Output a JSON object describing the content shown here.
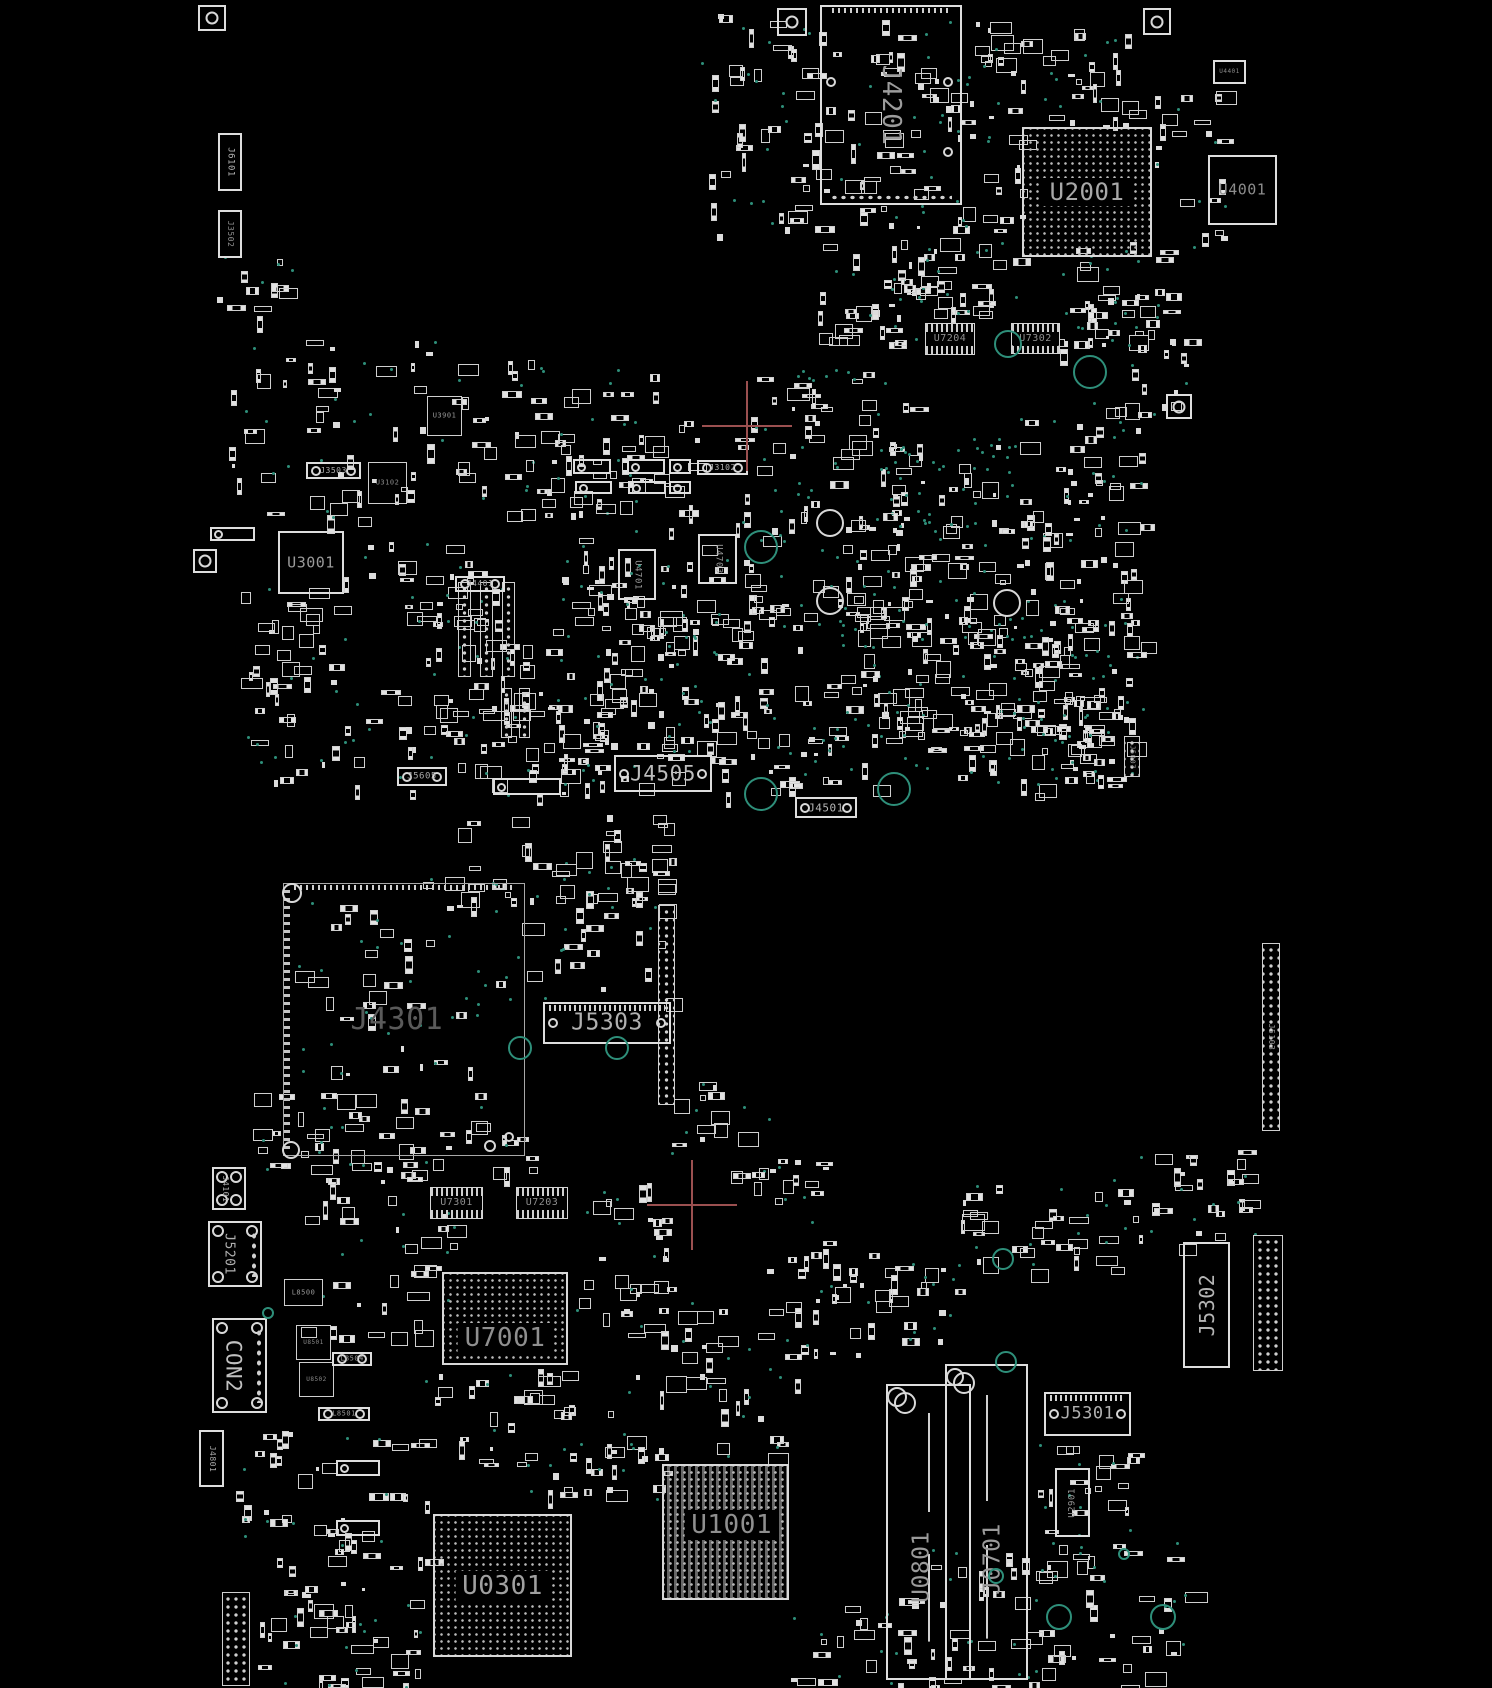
{
  "meta": {
    "width": 1492,
    "height": 1688,
    "background": "#000000"
  },
  "colors": {
    "silk": "#dedede",
    "label": "#9a9a9a",
    "label_dim": "#5a5a5a",
    "via": "#2e8f7a",
    "crosshair": "#9b5050"
  },
  "components": [
    {
      "id": "J6101",
      "label": "J6101",
      "x": 218,
      "y": 133,
      "w": 24,
      "h": 58,
      "type": "connector-v",
      "ls": 9,
      "lr": "cw",
      "lc": "#b5b5b5"
    },
    {
      "id": "J3502",
      "label": "J3502",
      "x": 218,
      "y": 210,
      "w": 24,
      "h": 48,
      "type": "connector-v",
      "ls": 8,
      "lr": "cw",
      "lc": "#8f8f8f"
    },
    {
      "id": "J4201",
      "label": "J4201",
      "x": 820,
      "y": 5,
      "w": 142,
      "h": 200,
      "type": "module",
      "ls": 26,
      "lr": "cw",
      "lc": "#9c9c9c"
    },
    {
      "id": "U2001",
      "label": "U2001",
      "x": 1022,
      "y": 127,
      "w": 130,
      "h": 130,
      "type": "bga",
      "ls": 24,
      "lc": "#a8a8a8"
    },
    {
      "id": "U4001",
      "label": "U4001",
      "x": 1208,
      "y": 155,
      "w": 69,
      "h": 70,
      "type": "chip",
      "ls": 15,
      "lc": "#8c8c8c"
    },
    {
      "id": "U4401",
      "label": "U4401",
      "x": 1213,
      "y": 60,
      "w": 33,
      "h": 24,
      "type": "chip",
      "ls": 6,
      "lc": "#8a8a8a"
    },
    {
      "id": "U7204",
      "label": "U7204",
      "x": 925,
      "y": 323,
      "w": 50,
      "h": 32,
      "type": "chip-pins",
      "ls": 10,
      "lc": "#8f8f8f"
    },
    {
      "id": "U7302",
      "label": "U7302",
      "x": 1011,
      "y": 323,
      "w": 49,
      "h": 31,
      "type": "chip-pins",
      "ls": 10,
      "lc": "#8f8f8f"
    },
    {
      "id": "U3901",
      "label": "U3901",
      "x": 427,
      "y": 396,
      "w": 35,
      "h": 40,
      "type": "chip-dark",
      "ls": 7,
      "lc": "#9a9a9a"
    },
    {
      "id": "J3503",
      "label": "J3503",
      "x": 306,
      "y": 462,
      "w": 55,
      "h": 17,
      "type": "connector-h",
      "ls": 8,
      "lc": "#b0b0b0"
    },
    {
      "id": "U3102",
      "label": "U3102",
      "x": 368,
      "y": 462,
      "w": 39,
      "h": 42,
      "type": "chip-dark",
      "ls": 7,
      "lc": "#8a8a8a"
    },
    {
      "id": "U3001",
      "label": "U3001",
      "x": 278,
      "y": 531,
      "w": 66,
      "h": 63,
      "type": "chip",
      "ls": 15,
      "lc": "#9a9a9a"
    },
    {
      "id": "J4401",
      "label": "J4401",
      "x": 455,
      "y": 576,
      "w": 50,
      "h": 16,
      "type": "connector-h",
      "ls": 8,
      "lc": "#a8a8a8"
    },
    {
      "id": "J3102",
      "label": "J3102",
      "x": 697,
      "y": 460,
      "w": 51,
      "h": 15,
      "type": "connector-h",
      "ls": 8,
      "lc": "#b0b0b0"
    },
    {
      "id": "U4701",
      "label": "U4701",
      "x": 618,
      "y": 549,
      "w": 38,
      "h": 51,
      "type": "chip-v",
      "ls": 9,
      "lr": "cw",
      "lc": "#9a9a9a"
    },
    {
      "id": "U4703",
      "label": "U4703",
      "x": 698,
      "y": 534,
      "w": 39,
      "h": 50,
      "type": "chip-v",
      "ls": 9,
      "lr": "cw",
      "lc": "#9a9a9a"
    },
    {
      "id": "J5605",
      "label": "J5605",
      "x": 397,
      "y": 767,
      "w": 50,
      "h": 19,
      "type": "connector-h",
      "ls": 9,
      "lc": "#a8a8a8"
    },
    {
      "id": "J4505",
      "label": "J4505",
      "x": 614,
      "y": 755,
      "w": 98,
      "h": 37,
      "type": "connector-h",
      "ls": 21,
      "lc": "#bdbdbd"
    },
    {
      "id": "J4501",
      "label": "J4501",
      "x": 795,
      "y": 797,
      "w": 62,
      "h": 21,
      "type": "connector-h",
      "ls": 11,
      "lc": "#b5b5b5"
    },
    {
      "id": "J5007",
      "label": "J5007",
      "x": 1124,
      "y": 736,
      "w": 16,
      "h": 41,
      "type": "connector-v",
      "ls": 7,
      "lr": "cw",
      "lc": "#9a9a9a"
    },
    {
      "id": "J4301",
      "label": "J4301",
      "x": 283,
      "y": 883,
      "w": 242,
      "h": 273,
      "type": "region",
      "ls": 30,
      "lc": "#5a5a5a",
      "lp": [
        0.47,
        0.5
      ]
    },
    {
      "id": "J5303",
      "label": "J5303",
      "x": 543,
      "y": 1002,
      "w": 128,
      "h": 42,
      "type": "connector-h-pads",
      "ls": 23,
      "lc": "#b0b0b0"
    },
    {
      "id": "J5103",
      "label": "J5103",
      "x": 1262,
      "y": 943,
      "w": 18,
      "h": 188,
      "type": "connector-v",
      "ls": 8,
      "lr": "cw",
      "lc": "#9a9a9a"
    },
    {
      "id": "J4101",
      "label": "J4101",
      "x": 212,
      "y": 1167,
      "w": 34,
      "h": 43,
      "type": "module-v",
      "ls": 8,
      "lr": "cw",
      "lc": "#b0b0b0"
    },
    {
      "id": "J5201",
      "label": "J5201",
      "x": 208,
      "y": 1221,
      "w": 54,
      "h": 66,
      "type": "module-v",
      "ls": 13,
      "lr": "cw",
      "lc": "#b0b0b0"
    },
    {
      "id": "CON2",
      "label": "CON2",
      "x": 212,
      "y": 1318,
      "w": 55,
      "h": 95,
      "type": "module-v",
      "ls": 21,
      "lr": "cw",
      "lc": "#c0c0c0"
    },
    {
      "id": "J4801",
      "label": "J4801",
      "x": 199,
      "y": 1430,
      "w": 25,
      "h": 57,
      "type": "connector-v",
      "ls": 8,
      "lr": "cw",
      "lc": "#a8a8a8"
    },
    {
      "id": "L8500",
      "label": "L8500",
      "x": 284,
      "y": 1279,
      "w": 39,
      "h": 27,
      "type": "chip-dark",
      "ls": 7,
      "lc": "#9a9a9a"
    },
    {
      "id": "U8501",
      "label": "U8501",
      "x": 296,
      "y": 1325,
      "w": 35,
      "h": 35,
      "type": "chip-dark",
      "ls": 6,
      "lc": "#8a8a8a"
    },
    {
      "id": "U8502",
      "label": "U8502",
      "x": 299,
      "y": 1362,
      "w": 35,
      "h": 35,
      "type": "chip-dark",
      "ls": 6,
      "lc": "#8a8a8a"
    },
    {
      "id": "L8504",
      "label": "L8504",
      "x": 332,
      "y": 1352,
      "w": 40,
      "h": 14,
      "type": "connector-h",
      "ls": 7,
      "lc": "#9a9a9a"
    },
    {
      "id": "L8501",
      "label": "L8501",
      "x": 318,
      "y": 1407,
      "w": 52,
      "h": 14,
      "type": "connector-h",
      "ls": 7,
      "lc": "#9a9a9a"
    },
    {
      "id": "U7301",
      "label": "U7301",
      "x": 430,
      "y": 1187,
      "w": 53,
      "h": 32,
      "type": "chip-pins",
      "ls": 10,
      "lc": "#8f8f8f"
    },
    {
      "id": "U7203",
      "label": "U7203",
      "x": 516,
      "y": 1187,
      "w": 52,
      "h": 32,
      "type": "chip-pins",
      "ls": 10,
      "lc": "#8f8f8f"
    },
    {
      "id": "U7001",
      "label": "U7001",
      "x": 442,
      "y": 1272,
      "w": 126,
      "h": 93,
      "type": "bga",
      "ls": 26,
      "lc": "#8f8f8f",
      "lp": [
        0.5,
        0.72
      ]
    },
    {
      "id": "U0301",
      "label": "U0301",
      "x": 433,
      "y": 1514,
      "w": 139,
      "h": 143,
      "type": "bga",
      "ls": 26,
      "lc": "#a0a0a0"
    },
    {
      "id": "U1001",
      "label": "U1001",
      "x": 662,
      "y": 1464,
      "w": 127,
      "h": 136,
      "type": "bga-traces",
      "ls": 26,
      "lc": "#8f8f8f",
      "lp": [
        0.55,
        0.45
      ]
    },
    {
      "id": "U0801",
      "label": "U0801",
      "x": 886,
      "y": 1384,
      "w": 85,
      "h": 296,
      "type": "slot",
      "ls": 23,
      "lr": "ccw",
      "lc": "#9a9a9a",
      "lp": [
        0.42,
        0.62
      ]
    },
    {
      "id": "J0701",
      "label": "J0701",
      "x": 945,
      "y": 1364,
      "w": 83,
      "h": 316,
      "type": "slot",
      "ls": 23,
      "lr": "ccw",
      "lc": "#9a9a9a",
      "lp": [
        0.58,
        0.62
      ]
    },
    {
      "id": "J5301",
      "label": "J5301",
      "x": 1044,
      "y": 1392,
      "w": 87,
      "h": 44,
      "type": "connector-h-pads",
      "ls": 17,
      "lc": "#b0b0b0"
    },
    {
      "id": "U2901",
      "label": "U2901",
      "x": 1055,
      "y": 1468,
      "w": 35,
      "h": 69,
      "type": "chip-v",
      "ls": 9,
      "lr": "ccw",
      "lc": "#9a9a9a"
    },
    {
      "id": "J5302",
      "label": "J5302",
      "x": 1183,
      "y": 1242,
      "w": 47,
      "h": 126,
      "type": "connector-v",
      "ls": 20,
      "lr": "ccw",
      "lc": "#b5b5b5"
    }
  ],
  "minor_parts": [
    {
      "x": 573,
      "y": 459,
      "w": 38,
      "h": 15,
      "type": "connector-h"
    },
    {
      "x": 627,
      "y": 459,
      "w": 38,
      "h": 15,
      "type": "connector-h"
    },
    {
      "x": 669,
      "y": 459,
      "w": 22,
      "h": 15,
      "type": "connector-h"
    },
    {
      "x": 575,
      "y": 481,
      "w": 37,
      "h": 13,
      "type": "connector-h"
    },
    {
      "x": 628,
      "y": 481,
      "w": 38,
      "h": 13,
      "type": "connector-h"
    },
    {
      "x": 669,
      "y": 481,
      "w": 22,
      "h": 13,
      "type": "connector-h"
    },
    {
      "x": 493,
      "y": 778,
      "w": 68,
      "h": 17,
      "type": "connector-h"
    },
    {
      "x": 210,
      "y": 527,
      "w": 45,
      "h": 14,
      "type": "connector-h"
    },
    {
      "x": 336,
      "y": 1460,
      "w": 44,
      "h": 16,
      "type": "connector-h"
    },
    {
      "x": 336,
      "y": 1520,
      "w": 44,
      "h": 16,
      "type": "connector-h"
    },
    {
      "x": 658,
      "y": 905,
      "w": 17,
      "h": 200,
      "type": "dot-strip-v"
    },
    {
      "x": 1253,
      "y": 1235,
      "w": 30,
      "h": 136,
      "type": "dot-strip-v"
    },
    {
      "x": 222,
      "y": 1592,
      "w": 28,
      "h": 94,
      "type": "dot-strip-v"
    },
    {
      "x": 458,
      "y": 582,
      "w": 13,
      "h": 95,
      "type": "dot-strip-v"
    },
    {
      "x": 480,
      "y": 582,
      "w": 13,
      "h": 95,
      "type": "dot-strip-v"
    },
    {
      "x": 502,
      "y": 582,
      "w": 13,
      "h": 95,
      "type": "dot-strip-v"
    },
    {
      "x": 501,
      "y": 688,
      "w": 11,
      "h": 50,
      "type": "dot-strip-v"
    },
    {
      "x": 519,
      "y": 688,
      "w": 11,
      "h": 50,
      "type": "dot-strip-v"
    }
  ],
  "fiducials": [
    {
      "x": 198,
      "y": 5,
      "w": 28,
      "h": 26
    },
    {
      "x": 777,
      "y": 8,
      "w": 30,
      "h": 28
    },
    {
      "x": 1143,
      "y": 8,
      "w": 28,
      "h": 27
    },
    {
      "x": 1166,
      "y": 394,
      "w": 26,
      "h": 25
    },
    {
      "x": 193,
      "y": 549,
      "w": 24,
      "h": 24
    }
  ],
  "holes": [
    [
      761,
      547,
      17
    ],
    [
      1090,
      372,
      17
    ],
    [
      1008,
      344,
      14
    ],
    [
      761,
      794,
      17
    ],
    [
      894,
      789,
      17
    ],
    [
      520,
      1048,
      12
    ],
    [
      617,
      1048,
      12
    ],
    [
      1003,
      1259,
      11
    ],
    [
      1006,
      1362,
      11
    ],
    [
      1059,
      1617,
      13
    ],
    [
      1163,
      1617,
      13
    ],
    [
      996,
      1576,
      8
    ],
    [
      1124,
      1554,
      6
    ],
    [
      268,
      1313,
      6
    ]
  ],
  "silk_circles": [
    [
      830,
      523,
      14
    ],
    [
      830,
      601,
      14
    ],
    [
      1007,
      603,
      14
    ],
    [
      292,
      893,
      10
    ],
    [
      291,
      1150,
      9
    ],
    [
      490,
      1146,
      6
    ],
    [
      509,
      1137,
      5
    ],
    [
      831,
      82,
      5
    ],
    [
      948,
      82,
      5
    ],
    [
      948,
      152,
      5
    ],
    [
      897,
      1397,
      10
    ],
    [
      955,
      1377,
      9
    ]
  ],
  "crosshairs": [
    [
      747,
      426
    ],
    [
      692,
      1205
    ]
  ],
  "clusters": [
    [
      700,
      12,
      165,
      245,
      55,
      18,
      1
    ],
    [
      868,
      18,
      155,
      125,
      45,
      16,
      2
    ],
    [
      875,
      145,
      145,
      165,
      45,
      18,
      3
    ],
    [
      1040,
      28,
      100,
      100,
      22,
      8,
      4
    ],
    [
      1058,
      240,
      125,
      115,
      30,
      12,
      5
    ],
    [
      1150,
      88,
      75,
      160,
      18,
      6,
      6
    ],
    [
      818,
      248,
      165,
      100,
      32,
      12,
      7
    ],
    [
      1085,
      300,
      100,
      120,
      22,
      10,
      8
    ],
    [
      225,
      340,
      250,
      180,
      52,
      16,
      9
    ],
    [
      480,
      355,
      175,
      145,
      32,
      10,
      10
    ],
    [
      505,
      420,
      195,
      95,
      26,
      8,
      11
    ],
    [
      735,
      368,
      175,
      130,
      36,
      22,
      12
    ],
    [
      878,
      438,
      145,
      92,
      26,
      42,
      13
    ],
    [
      1018,
      418,
      125,
      120,
      28,
      12,
      14
    ],
    [
      560,
      498,
      185,
      160,
      36,
      12,
      15
    ],
    [
      740,
      488,
      165,
      140,
      36,
      15,
      16
    ],
    [
      832,
      518,
      200,
      120,
      40,
      15,
      17
    ],
    [
      1020,
      518,
      120,
      160,
      26,
      12,
      18
    ],
    [
      240,
      560,
      120,
      225,
      40,
      10,
      19
    ],
    [
      358,
      538,
      145,
      120,
      26,
      8,
      20
    ],
    [
      432,
      592,
      130,
      125,
      28,
      8,
      21
    ],
    [
      562,
      560,
      130,
      135,
      26,
      10,
      22
    ],
    [
      600,
      600,
      205,
      120,
      34,
      12,
      23
    ],
    [
      820,
      558,
      185,
      160,
      40,
      15,
      24
    ],
    [
      1000,
      578,
      125,
      140,
      26,
      10,
      25
    ],
    [
      215,
      250,
      85,
      70,
      10,
      4,
      26
    ],
    [
      340,
      690,
      220,
      105,
      40,
      12,
      27
    ],
    [
      562,
      692,
      158,
      68,
      26,
      8,
      28
    ],
    [
      718,
      688,
      185,
      108,
      34,
      16,
      29
    ],
    [
      858,
      618,
      245,
      158,
      45,
      18,
      30
    ],
    [
      1038,
      620,
      105,
      158,
      22,
      10,
      31
    ],
    [
      555,
      730,
      125,
      65,
      20,
      6,
      32
    ],
    [
      293,
      900,
      225,
      175,
      30,
      28,
      33
    ],
    [
      420,
      815,
      245,
      92,
      38,
      10,
      34
    ],
    [
      522,
      858,
      150,
      140,
      26,
      8,
      35
    ],
    [
      250,
      1090,
      285,
      78,
      42,
      10,
      36
    ],
    [
      298,
      1158,
      155,
      180,
      38,
      12,
      37
    ],
    [
      572,
      1178,
      98,
      158,
      26,
      8,
      38
    ],
    [
      598,
      1298,
      205,
      162,
      38,
      14,
      39
    ],
    [
      742,
      1158,
      82,
      130,
      14,
      5,
      40
    ],
    [
      790,
      1248,
      172,
      112,
      36,
      12,
      41
    ],
    [
      958,
      1178,
      185,
      92,
      32,
      12,
      42
    ],
    [
      1038,
      1440,
      102,
      122,
      22,
      10,
      43
    ],
    [
      928,
      1540,
      262,
      146,
      52,
      20,
      44
    ],
    [
      220,
      1428,
      205,
      132,
      38,
      10,
      45
    ],
    [
      255,
      1560,
      165,
      126,
      40,
      12,
      46
    ],
    [
      420,
      1368,
      155,
      122,
      28,
      8,
      47
    ],
    [
      560,
      1398,
      105,
      102,
      18,
      6,
      48
    ],
    [
      788,
      1598,
      145,
      90,
      22,
      8,
      49
    ],
    [
      1138,
      1148,
      120,
      100,
      22,
      8,
      50
    ],
    [
      655,
      1078,
      130,
      95,
      16,
      6,
      51
    ],
    [
      900,
      690,
      210,
      105,
      36,
      14,
      52
    ],
    [
      1040,
      700,
      90,
      90,
      14,
      6,
      53
    ]
  ]
}
